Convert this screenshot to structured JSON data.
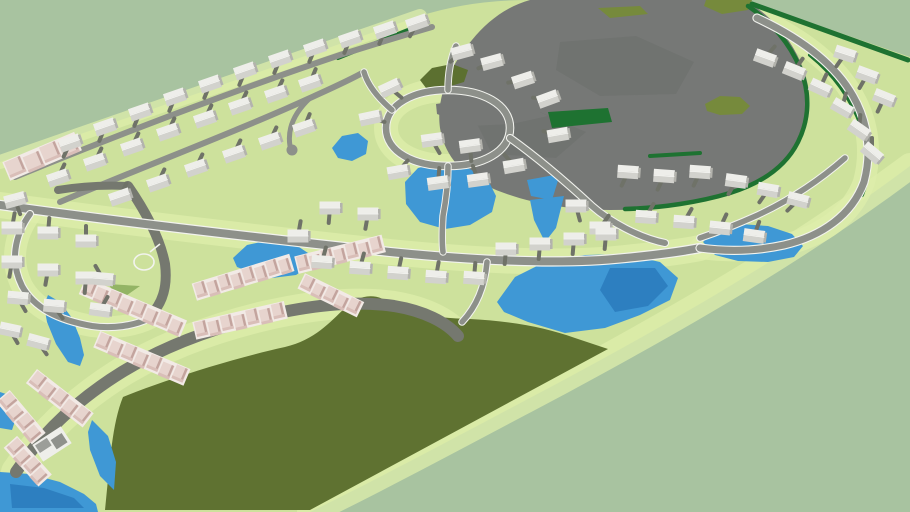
{
  "viewport": {
    "width": 910,
    "height": 512,
    "description": "aerial 3d rendering of a master planned residential community model"
  },
  "colors": {
    "background": "#a8c3a0",
    "terrain": "#cde19c",
    "lawn_light": "#ddeeab",
    "forest": "#5f7231",
    "clearing": "#767876",
    "clearing_dark": "#686b68",
    "clearing_olive": "#768a3c",
    "scrub": "#5c7030",
    "park": "#93b465",
    "hedge": "#1e7231",
    "water": "#3f98d5",
    "water_deep": "#2d7fc0",
    "road": "#8d908a",
    "road_edge": "#f2f3ee",
    "local_road": "#75786f",
    "driveway": "#6f7268",
    "house_roof_light": "#eeeeea",
    "house_roof_dark": "#d2d2cd",
    "house_side": "#b3b3ad",
    "house_wall": "#fafaf7",
    "townhome_roof": "#e7d4ce",
    "townhome_side": "#c3a49e",
    "townhome_front": "#d9beb8",
    "townhome_seam": "#f2eae6",
    "club_roof": "#9c9e99",
    "club_roof_dark": "#8f918c"
  },
  "scene": {
    "counts": {
      "houses": 84,
      "townhome_rows": 10,
      "ponds": 11,
      "construction_areas": 2
    },
    "houses": [
      [
        70,
        143,
        -19,
        115
      ],
      [
        105,
        127,
        -19,
        112
      ],
      [
        140,
        112,
        -19,
        112
      ],
      [
        175,
        97,
        -19,
        112
      ],
      [
        210,
        84,
        -19,
        112
      ],
      [
        245,
        71,
        -19,
        112
      ],
      [
        280,
        59,
        -19,
        112
      ],
      [
        315,
        48,
        -19,
        112
      ],
      [
        350,
        39,
        -19,
        112
      ],
      [
        385,
        30,
        -19,
        112
      ],
      [
        417,
        23,
        -19,
        118
      ],
      [
        58,
        178,
        -19,
        -65
      ],
      [
        95,
        162,
        -19,
        -65
      ],
      [
        132,
        147,
        -19,
        -65
      ],
      [
        168,
        132,
        -19,
        -65
      ],
      [
        205,
        119,
        -19,
        -65
      ],
      [
        240,
        106,
        -19,
        -65
      ],
      [
        276,
        94,
        -19,
        -65
      ],
      [
        310,
        83,
        -19,
        -68
      ],
      [
        120,
        197,
        -19,
        -65
      ],
      [
        158,
        183,
        -19,
        -65
      ],
      [
        196,
        168,
        -19,
        -65
      ],
      [
        234,
        154,
        -19,
        -65
      ],
      [
        270,
        141,
        -19,
        -65
      ],
      [
        304,
        128,
        -19,
        -68
      ],
      [
        370,
        118,
        -12,
        15
      ],
      [
        390,
        88,
        -25,
        40
      ],
      [
        462,
        52,
        -15,
        140
      ],
      [
        492,
        62,
        -15,
        155
      ],
      [
        523,
        80,
        -18,
        170
      ],
      [
        548,
        99,
        -20,
        185
      ],
      [
        558,
        135,
        -10,
        195
      ],
      [
        432,
        140,
        -8,
        60
      ],
      [
        470,
        146,
        -8,
        85
      ],
      [
        398,
        172,
        -10,
        -50
      ],
      [
        438,
        183,
        -8,
        -85
      ],
      [
        478,
        180,
        -8,
        -110
      ],
      [
        514,
        166,
        -10,
        -130
      ],
      [
        765,
        58,
        20,
        -50
      ],
      [
        794,
        71,
        22,
        -55
      ],
      [
        820,
        88,
        25,
        -65
      ],
      [
        842,
        108,
        30,
        -75
      ],
      [
        859,
        130,
        35,
        -85
      ],
      [
        872,
        153,
        40,
        -90
      ],
      [
        884,
        98,
        22,
        115
      ],
      [
        867,
        75,
        20,
        120
      ],
      [
        845,
        54,
        18,
        125
      ],
      [
        628,
        172,
        4,
        115
      ],
      [
        664,
        176,
        4,
        115
      ],
      [
        700,
        172,
        4,
        115
      ],
      [
        736,
        181,
        8,
        120
      ],
      [
        768,
        190,
        10,
        125
      ],
      [
        798,
        200,
        14,
        135
      ],
      [
        646,
        217,
        4,
        -60
      ],
      [
        684,
        222,
        4,
        -60
      ],
      [
        720,
        228,
        6,
        -65
      ],
      [
        754,
        236,
        8,
        -70
      ],
      [
        600,
        228,
        0,
        -55
      ],
      [
        576,
        206,
        0,
        75
      ],
      [
        322,
        262,
        4,
        -75
      ],
      [
        360,
        268,
        4,
        -75
      ],
      [
        398,
        273,
        4,
        -78
      ],
      [
        436,
        277,
        4,
        -80
      ],
      [
        474,
        278,
        4,
        -85
      ],
      [
        506,
        249,
        0,
        95
      ],
      [
        540,
        244,
        0,
        95
      ],
      [
        574,
        239,
        0,
        95
      ],
      [
        606,
        234,
        0,
        95
      ],
      [
        330,
        208,
        0,
        95
      ],
      [
        368,
        214,
        0,
        100
      ],
      [
        298,
        236,
        0,
        -80
      ],
      [
        12,
        228,
        0,
        -80
      ],
      [
        48,
        233,
        0,
        -85
      ],
      [
        86,
        241,
        0,
        -90
      ],
      [
        12,
        262,
        0,
        100
      ],
      [
        48,
        270,
        0,
        100
      ],
      [
        86,
        278,
        0,
        95
      ],
      [
        18,
        298,
        5,
        60
      ],
      [
        54,
        306,
        5,
        55
      ],
      [
        103,
        279,
        5,
        -120
      ],
      [
        100,
        310,
        8,
        -60
      ],
      [
        15,
        200,
        -15,
        70
      ],
      [
        10,
        330,
        12,
        60
      ],
      [
        38,
        342,
        15,
        55
      ]
    ],
    "townhome_rows": [
      [
        42,
        156,
        76,
        15,
        -23,
        4
      ],
      [
        243,
        277,
        100,
        13,
        -17,
        8
      ],
      [
        340,
        254,
        88,
        13,
        -14,
        7
      ],
      [
        240,
        320,
        92,
        13,
        -13,
        7
      ],
      [
        133,
        307,
        108,
        13,
        23,
        8
      ],
      [
        142,
        358,
        96,
        13,
        23,
        7
      ],
      [
        331,
        295,
        64,
        12,
        26,
        5
      ],
      [
        60,
        398,
        70,
        13,
        38,
        5
      ],
      [
        21,
        417,
        54,
        13,
        50,
        4
      ],
      [
        28,
        461,
        50,
        13,
        48,
        4
      ]
    ],
    "ponds": [
      {
        "pts": [
          [
            405,
            182
          ],
          [
            418,
            168
          ],
          [
            442,
            162
          ],
          [
            468,
            168
          ],
          [
            488,
            180
          ],
          [
            496,
            196
          ],
          [
            492,
            212
          ],
          [
            470,
            225
          ],
          [
            445,
            229
          ],
          [
            420,
            222
          ],
          [
            406,
            204
          ]
        ]
      },
      {
        "pts": [
          [
            527,
            180
          ],
          [
            560,
            174
          ],
          [
            552,
            200
          ],
          [
            531,
            196
          ]
        ]
      },
      {
        "pts": [
          [
            530,
            200
          ],
          [
            564,
            196
          ],
          [
            556,
            228
          ],
          [
            545,
            242
          ],
          [
            534,
            220
          ]
        ]
      },
      {
        "pts": [
          [
            497,
            302
          ],
          [
            515,
            277
          ],
          [
            545,
            262
          ],
          [
            585,
            255
          ],
          [
            625,
            254
          ],
          [
            660,
            262
          ],
          [
            678,
            278
          ],
          [
            670,
            300
          ],
          [
            640,
            315
          ],
          [
            605,
            328
          ],
          [
            565,
            333
          ],
          [
            528,
            322
          ],
          [
            504,
            312
          ]
        ],
        "deep": [
          [
            610,
            268
          ],
          [
            655,
            268
          ],
          [
            668,
            286
          ],
          [
            648,
            306
          ],
          [
            615,
            312
          ],
          [
            600,
            290
          ]
        ]
      },
      {
        "pts": [
          [
            703,
            242
          ],
          [
            715,
            230
          ],
          [
            740,
            224
          ],
          [
            768,
            226
          ],
          [
            792,
            234
          ],
          [
            803,
            246
          ],
          [
            794,
            257
          ],
          [
            768,
            262
          ],
          [
            738,
            261
          ],
          [
            715,
            255
          ]
        ]
      },
      {
        "pts": [
          [
            233,
            258
          ],
          [
            247,
            245
          ],
          [
            270,
            240
          ],
          [
            293,
            243
          ],
          [
            308,
            253
          ],
          [
            310,
            266
          ],
          [
            296,
            275
          ],
          [
            272,
            278
          ],
          [
            250,
            272
          ],
          [
            237,
            267
          ]
        ]
      },
      {
        "pts": [
          [
            48,
            295
          ],
          [
            60,
            302
          ],
          [
            72,
            318
          ],
          [
            80,
            338
          ],
          [
            84,
            355
          ],
          [
            80,
            366
          ],
          [
            68,
            362
          ],
          [
            56,
            344
          ],
          [
            47,
            322
          ],
          [
            44,
            305
          ]
        ]
      },
      {
        "pts": [
          [
            332,
            148
          ],
          [
            342,
            136
          ],
          [
            358,
            133
          ],
          [
            368,
            141
          ],
          [
            366,
            154
          ],
          [
            352,
            161
          ],
          [
            338,
            158
          ]
        ]
      },
      {
        "pts": [
          [
            0,
            392
          ],
          [
            12,
            396
          ],
          [
            18,
            412
          ],
          [
            12,
            430
          ],
          [
            0,
            428
          ]
        ]
      },
      {
        "pts": [
          [
            0,
            472
          ],
          [
            30,
            474
          ],
          [
            60,
            482
          ],
          [
            84,
            494
          ],
          [
            96,
            504
          ],
          [
            98,
            512
          ],
          [
            0,
            512
          ]
        ],
        "deep": [
          [
            10,
            484
          ],
          [
            44,
            488
          ],
          [
            74,
            498
          ],
          [
            84,
            508
          ],
          [
            12,
            508
          ]
        ]
      },
      {
        "pts": [
          [
            92,
            420
          ],
          [
            108,
            436
          ],
          [
            116,
            462
          ],
          [
            114,
            490
          ],
          [
            100,
            476
          ],
          [
            90,
            450
          ],
          [
            88,
            432
          ]
        ]
      }
    ],
    "gray_mottles": [
      [
        [
          560,
          42
        ],
        [
          636,
          36
        ],
        [
          694,
          62
        ],
        [
          676,
          94
        ],
        [
          600,
          96
        ],
        [
          556,
          70
        ]
      ],
      [
        [
          476,
          122
        ],
        [
          540,
          112
        ],
        [
          586,
          132
        ],
        [
          556,
          158
        ],
        [
          492,
          154
        ]
      ]
    ],
    "inner_gray": [
      [
        436,
        104
      ],
      [
        502,
        94
      ],
      [
        548,
        116
      ],
      [
        512,
        124
      ],
      [
        470,
        126
      ],
      [
        437,
        114
      ]
    ],
    "olive_patches": [
      [
        [
          706,
          0
        ],
        [
          752,
          0
        ],
        [
          748,
          10
        ],
        [
          722,
          14
        ],
        [
          704,
          6
        ]
      ],
      [
        [
          705,
          104
        ],
        [
          720,
          96
        ],
        [
          740,
          97
        ],
        [
          750,
          106
        ],
        [
          742,
          114
        ],
        [
          720,
          115
        ],
        [
          707,
          111
        ]
      ],
      [
        [
          598,
          8
        ],
        [
          640,
          6
        ],
        [
          648,
          14
        ],
        [
          610,
          18
        ]
      ]
    ],
    "scrub_patches": [
      [
        [
          420,
          80
        ],
        [
          432,
          68
        ],
        [
          452,
          64
        ],
        [
          468,
          70
        ],
        [
          464,
          82
        ],
        [
          444,
          88
        ],
        [
          426,
          88
        ]
      ]
    ],
    "park_patches": [
      [
        [
          108,
          284
        ],
        [
          140,
          286
        ],
        [
          120,
          300
        ]
      ]
    ],
    "hedge_fills": [
      [
        [
          548,
          112
        ],
        [
          608,
          108
        ],
        [
          612,
          122
        ],
        [
          552,
          128
        ]
      ]
    ]
  }
}
